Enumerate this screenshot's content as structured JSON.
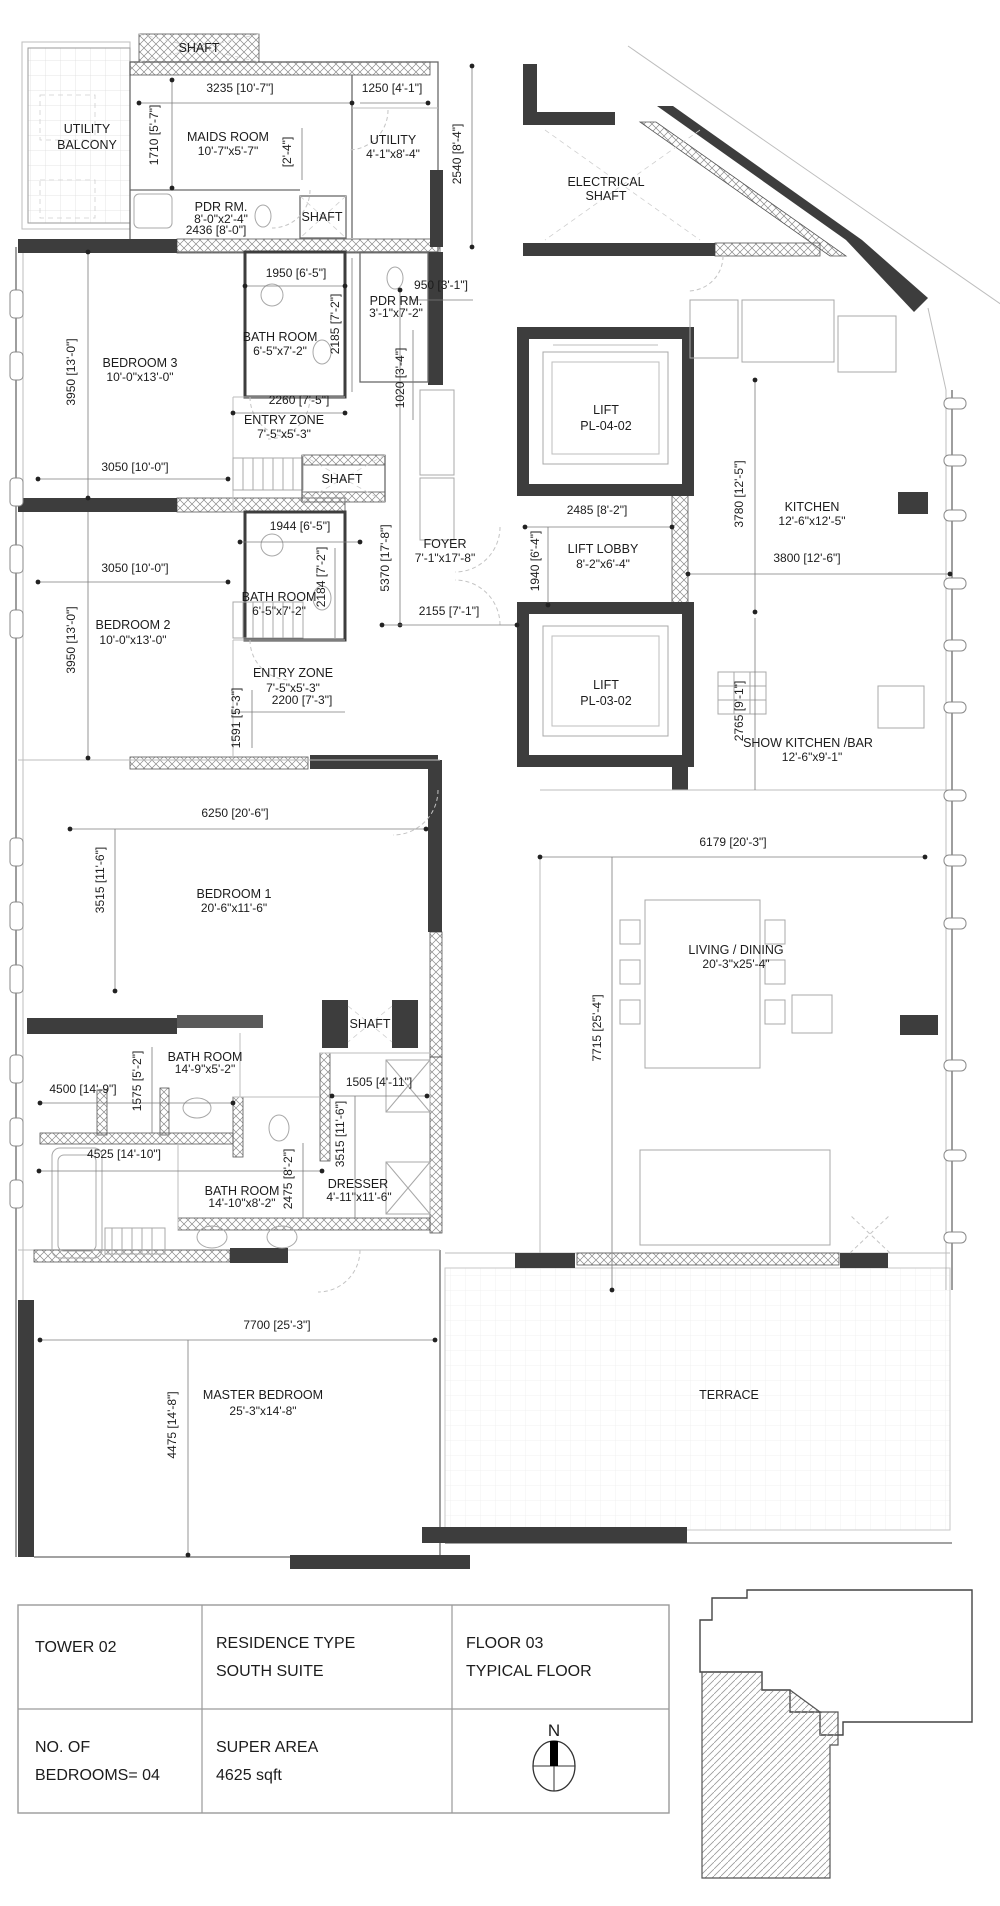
{
  "plan": {
    "rooms": {
      "shaft_top": "SHAFT",
      "utility_balcony_line1": "UTILITY",
      "utility_balcony_line2": "BALCONY",
      "maids_name": "MAIDS ROOM",
      "maids_size": "10'-7\"x5'-7\"",
      "utility_name": "UTILITY",
      "utility_size": "4'-1\"x8'-4\"",
      "pdr1_name": "PDR RM.",
      "pdr1_size": "8'-0\"x2'-4\"",
      "shaft_a": "SHAFT",
      "electrical_line1": "ELECTRICAL",
      "electrical_line2": "SHAFT",
      "pdr2_name": "PDR RM.",
      "pdr2_size": "3'-1\"x7'-2\"",
      "bedroom3_name": "BEDROOM 3",
      "bedroom3_size": "10'-0\"x13'-0\"",
      "bath3_name": "BATH ROOM",
      "bath3_size": "6'-5\"x7'-2\"",
      "entry1_name": "ENTRY ZONE",
      "entry1_size": "7'-5\"x5'-3\"",
      "shaft_b": "SHAFT",
      "lift1_name": "LIFT",
      "lift1_code": "PL-04-02",
      "lobby_name": "LIFT LOBBY",
      "lobby_size": "8'-2\"x6'-4\"",
      "foyer_name": "FOYER",
      "foyer_size": "7'-1\"x17'-8\"",
      "kitchen_name": "KITCHEN",
      "kitchen_size": "12'-6\"x12'-5\"",
      "bedroom2_name": "BEDROOM 2",
      "bedroom2_size": "10'-0\"x13'-0\"",
      "bath2_name": "BATH ROOM",
      "bath2_size": "6'-5\"x7'-2\"",
      "entry2_name": "ENTRY ZONE",
      "entry2_size": "7'-5\"x5'-3\"",
      "lift2_name": "LIFT",
      "lift2_code": "PL-03-02",
      "show_kitchen_name": "SHOW KITCHEN /BAR",
      "show_kitchen_size": "12'-6\"x9'-1\"",
      "bedroom1_name": "BEDROOM 1",
      "bedroom1_size": "20'-6\"x11'-6\"",
      "living_name": "LIVING / DINING",
      "living_size": "20'-3\"x25'-4\"",
      "shaft_c": "SHAFT",
      "bathm1_name": "BATH ROOM",
      "bathm1_size": "14'-9\"x5'-2\"",
      "bathm2_name": "BATH ROOM",
      "bathm2_size": "14'-10\"x8'-2\"",
      "dresser_name": "DRESSER",
      "dresser_size": "4'-11\"x11'-6\"",
      "master_name": "MASTER BEDROOM",
      "master_size": "25'-3\"x14'-8\"",
      "terrace_name": "TERRACE"
    },
    "dims": {
      "d3235": "3235 [10'-7\"]",
      "d1250": "1250 [4'-1\"]",
      "d1710": "1710 [5'-7\"]",
      "d2_4": "[2'-4\"]",
      "d2540": "2540 [8'-4\"]",
      "d2436": "2436 [8'-0\"]",
      "d950": "950 [3'-1\"]",
      "d1950": "1950 [6'-5\"]",
      "d2185": "2185 [7'-2\"]",
      "d2260": "2260 [7'-5\"]",
      "d1020": "1020 [3'-4\"]",
      "d3950a": "3950 [13'-0\"]",
      "d3950b": "3950 [13'-0\"]",
      "d3050a": "3050 [10'-0\"]",
      "d3050b": "3050 [10'-0\"]",
      "d1944": "1944 [6'-5\"]",
      "d2184": "2184 [7'-2\"]",
      "d5370": "5370 [17'-8\"]",
      "d2155": "2155 [7'-1\"]",
      "d2485": "2485 [8'-2\"]",
      "d1940": "1940 [6'-4\"]",
      "d3780": "3780 [12'-5\"]",
      "d3800": "3800 [12'-6\"]",
      "d2200": "2200 [7'-3\"]",
      "d1591": "1591 [5'-3\"]",
      "d2765": "2765 [9'-1\"]",
      "d6250": "6250 [20'-6\"]",
      "d3515a": "3515 [11'-6\"]",
      "d3515b": "3515 [11'-6\"]",
      "d6179": "6179 [20'-3\"]",
      "d7715": "7715 [25'-4\"]",
      "d4500": "4500 [14'-9\"]",
      "d1575": "1575 [5'-2\"]",
      "d4525": "4525 [14'-10\"]",
      "d2475": "2475 [8'-2\"]",
      "d1505": "1505 [4'-11\"]",
      "d7700": "7700 [25'-3\"]",
      "d4475": "4475 [14'-8\"]"
    }
  },
  "title_block": {
    "tower": "TOWER 02",
    "residence_line1": "RESIDENCE TYPE",
    "residence_line2": "SOUTH SUITE",
    "floor_line1": "FLOOR 03",
    "floor_line2": "TYPICAL FLOOR",
    "bedrooms_line1": "NO. OF",
    "bedrooms_line2": "BEDROOMS= 04",
    "area_line1": "SUPER AREA",
    "area_line2": "4625 sqft",
    "north": "N"
  },
  "colors": {
    "paper": "#ffffff",
    "wall_dark": "#3d3d3d",
    "hatch_gray": "#8a8a8a",
    "text": "#1c1c1c"
  }
}
